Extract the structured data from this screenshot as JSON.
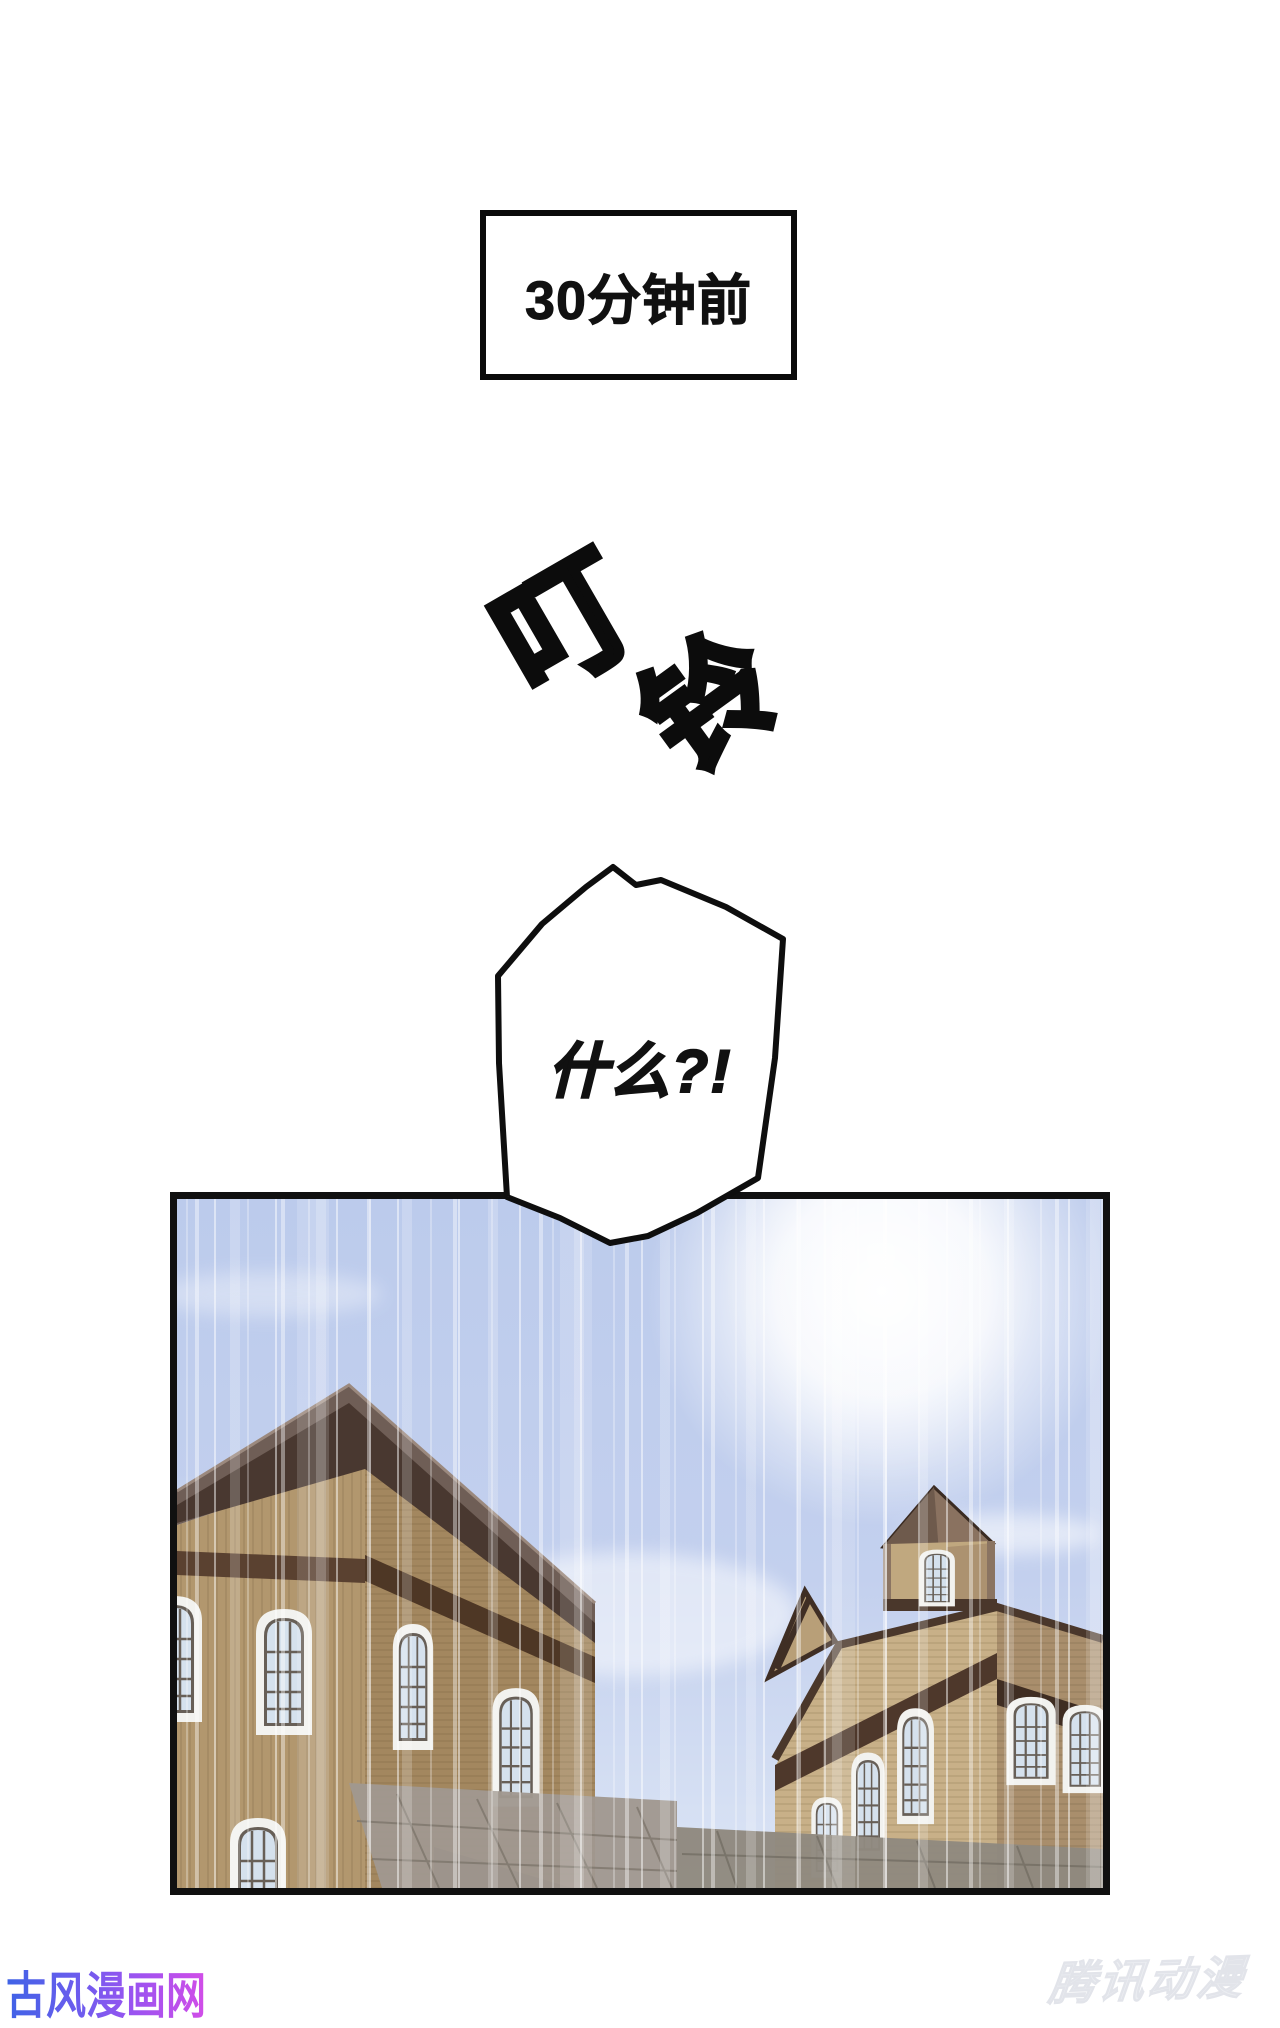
{
  "page": {
    "width": 1280,
    "height": 2028,
    "background": "#ffffff"
  },
  "caption_box": {
    "text": "30分钟前"
  },
  "sfx": {
    "char_1": "叮",
    "char_2": "铃"
  },
  "speech_bubble": {
    "text": "什么?!"
  },
  "panel": {
    "colors": {
      "sky_top": "#bccbec",
      "sky_bottom": "#dce5f5",
      "sun_glow": "#ffffff",
      "left_building_wall": "#b2976e",
      "left_building_side_wall": "#a3875f",
      "left_building_roof": "#6f5e56",
      "roof_fascia_dark": "#493830",
      "wall_band_brown": "#5a4130",
      "right_building_wall": "#c8b088",
      "right_building_side_wall": "#a98e6c",
      "foreground_roof_gray": "#a09890",
      "foreground_roof_gray_right": "#90897f",
      "window_glass": "#d5e1ed",
      "panel_border": "#101010"
    }
  },
  "watermarks": {
    "bottom_left": {
      "text": "古风漫画网",
      "gradient_start": "#4a6ce8",
      "gradient_end": "#d24de8"
    },
    "bottom_right": {
      "text": "腾讯动漫",
      "color": "#eceef2"
    }
  }
}
